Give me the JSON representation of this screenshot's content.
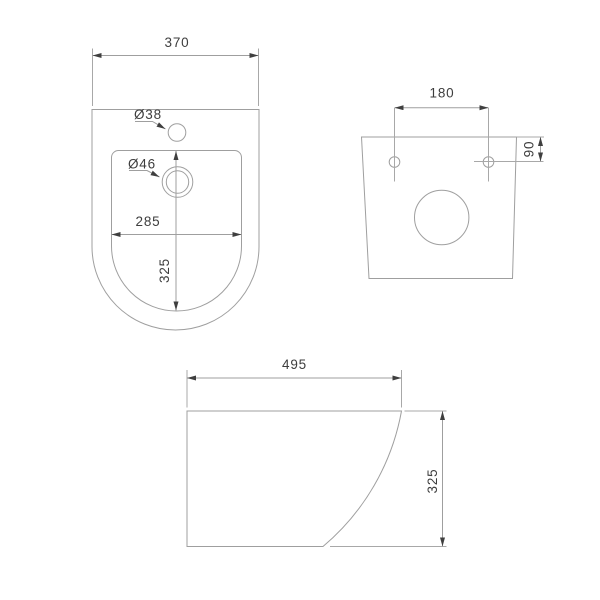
{
  "colors": {
    "background": "#ffffff",
    "line": "#9f9f9f",
    "text": "#3d3d3d",
    "arrow": "#3f3f3f"
  },
  "views": {
    "top": {
      "overall_width": "370",
      "tap_hole_diameter": "Ø38",
      "drain_hole_diameter": "Ø46",
      "inner_width": "285",
      "inner_depth": "325"
    },
    "back": {
      "hole_spacing": "180",
      "hole_offset": "90"
    },
    "side": {
      "length": "495",
      "height": "325"
    }
  }
}
